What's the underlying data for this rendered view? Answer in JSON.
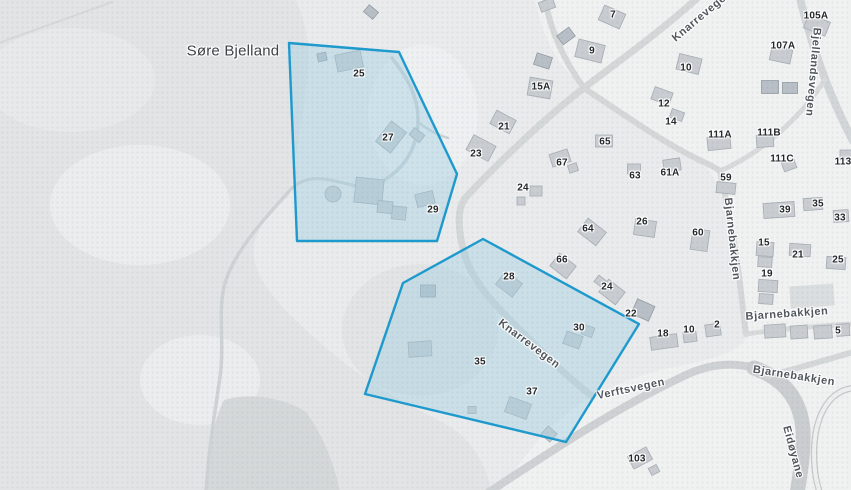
{
  "map": {
    "colors": {
      "base": "#e9ebec",
      "terrain_dark": "#e2e4e5",
      "terrain_light": "#ebedee",
      "field_dark": "#d5d8d9",
      "urban": "#f0f1f1",
      "building_fill": "#c9cdd1",
      "building_stroke": "#a6adb4",
      "building_dark": "#b9bfc6",
      "building_dark_stroke": "#959ca4",
      "building_light": "#dadedf",
      "selection_stroke": "#1d9ace",
      "selection_fill": "rgba(160,207,227,0.42)"
    },
    "place_labels": [
      {
        "text": "Søre Bjelland",
        "x": 233,
        "y": 51,
        "rot": 0
      }
    ],
    "street_labels": [
      {
        "text": "Knarrevegen",
        "x": 702,
        "y": 16,
        "rot": -40
      },
      {
        "text": "Bjellandsvegen",
        "x": 813,
        "y": 72,
        "rot": 95
      },
      {
        "text": "Bjarnebakkjen",
        "x": 732,
        "y": 239,
        "rot": 84
      },
      {
        "text": "Bjarnebakkjen",
        "x": 787,
        "y": 314,
        "rot": -4
      },
      {
        "text": "Bjarnebakkjen",
        "x": 794,
        "y": 376,
        "rot": 9
      },
      {
        "text": "Verftsvegen",
        "x": 631,
        "y": 389,
        "rot": -12
      },
      {
        "text": "Knarrevegen",
        "x": 529,
        "y": 344,
        "rot": 37
      },
      {
        "text": "Eidøyane",
        "x": 793,
        "y": 452,
        "rot": 75
      }
    ],
    "house_numbers": [
      {
        "text": "25",
        "x": 359,
        "y": 74
      },
      {
        "text": "27",
        "x": 388,
        "y": 138
      },
      {
        "text": "29",
        "x": 433,
        "y": 210
      },
      {
        "text": "7",
        "x": 613,
        "y": 15
      },
      {
        "text": "9",
        "x": 592,
        "y": 51
      },
      {
        "text": "15A",
        "x": 541,
        "y": 87
      },
      {
        "text": "21",
        "x": 504,
        "y": 127
      },
      {
        "text": "23",
        "x": 476,
        "y": 154
      },
      {
        "text": "24",
        "x": 523,
        "y": 188
      },
      {
        "text": "10",
        "x": 686,
        "y": 68
      },
      {
        "text": "12",
        "x": 664,
        "y": 104
      },
      {
        "text": "14",
        "x": 671,
        "y": 122
      },
      {
        "text": "105A",
        "x": 816,
        "y": 16
      },
      {
        "text": "107A",
        "x": 783,
        "y": 46
      },
      {
        "text": "111A",
        "x": 720,
        "y": 135
      },
      {
        "text": "111B",
        "x": 769,
        "y": 133
      },
      {
        "text": "111C",
        "x": 782,
        "y": 159
      },
      {
        "text": "113",
        "x": 843,
        "y": 162
      },
      {
        "text": "65",
        "x": 605,
        "y": 142
      },
      {
        "text": "67",
        "x": 562,
        "y": 163
      },
      {
        "text": "63",
        "x": 635,
        "y": 176
      },
      {
        "text": "61A",
        "x": 670,
        "y": 173
      },
      {
        "text": "59",
        "x": 726,
        "y": 178
      },
      {
        "text": "26",
        "x": 642,
        "y": 222
      },
      {
        "text": "64",
        "x": 588,
        "y": 229
      },
      {
        "text": "60",
        "x": 698,
        "y": 233
      },
      {
        "text": "66",
        "x": 562,
        "y": 260
      },
      {
        "text": "28",
        "x": 509,
        "y": 277
      },
      {
        "text": "24",
        "x": 607,
        "y": 287
      },
      {
        "text": "22",
        "x": 631,
        "y": 314
      },
      {
        "text": "30",
        "x": 579,
        "y": 328
      },
      {
        "text": "18",
        "x": 663,
        "y": 334
      },
      {
        "text": "10",
        "x": 689,
        "y": 330
      },
      {
        "text": "2",
        "x": 717,
        "y": 325
      },
      {
        "text": "39",
        "x": 785,
        "y": 210
      },
      {
        "text": "35",
        "x": 818,
        "y": 204
      },
      {
        "text": "33",
        "x": 840,
        "y": 218
      },
      {
        "text": "15",
        "x": 764,
        "y": 243
      },
      {
        "text": "21",
        "x": 798,
        "y": 255
      },
      {
        "text": "25",
        "x": 838,
        "y": 260
      },
      {
        "text": "19",
        "x": 767,
        "y": 274
      },
      {
        "text": "5",
        "x": 838,
        "y": 331
      },
      {
        "text": "35",
        "x": 480,
        "y": 362
      },
      {
        "text": "37",
        "x": 532,
        "y": 392
      },
      {
        "text": "103",
        "x": 637,
        "y": 459
      }
    ],
    "selection": {
      "stroke": "#1d9ace",
      "fill": "rgba(160,207,227,0.42)",
      "polygons": [
        [
          [
            289,
            43
          ],
          [
            399,
            52
          ],
          [
            457,
            174
          ],
          [
            437,
            241
          ],
          [
            297,
            241
          ]
        ],
        [
          [
            483,
            239
          ],
          [
            403,
            283
          ],
          [
            365,
            394
          ],
          [
            566,
            442
          ],
          [
            639,
            324
          ]
        ]
      ]
    },
    "terrain": [
      {
        "kind": "path",
        "fill": "terrain_dark",
        "d": "M0,0 L295,0 C312,30 310,70 303,110 C297,150 293,175 289,196 C270,213 251,230 254,258 C259,290 298,324 336,356 C370,384 402,402 438,420 C468,434 484,458 492,492 L0,492 Z"
      },
      {
        "kind": "ellipse",
        "fill": "terrain_light",
        "cx": 140,
        "cy": 205,
        "rx": 90,
        "ry": 60
      },
      {
        "kind": "ellipse",
        "fill": "terrain_light",
        "cx": 200,
        "cy": 380,
        "rx": 60,
        "ry": 45
      },
      {
        "kind": "ellipse",
        "fill": "#e7e9ea",
        "cx": 70,
        "cy": 80,
        "rx": 85,
        "ry": 52
      },
      {
        "kind": "ellipse",
        "fill": "terrain_dark",
        "cx": 420,
        "cy": 330,
        "rx": 78,
        "ry": 66
      },
      {
        "kind": "path",
        "fill": "field_dark",
        "d": "M204,492 C208,448 214,420 224,400 C250,392 285,398 306,412 C322,434 334,462 340,492 Z"
      },
      {
        "kind": "path",
        "fill": "urban",
        "d": "M535,0 L851,0 L851,492 L500,492 C525,452 548,428 572,410 C605,386 645,372 688,364 C722,357 746,348 747,334 C741,296 735,255 726,213 C719,184 711,170 698,158 C658,135 618,110 584,86 C558,68 543,38 535,0 Z"
      },
      {
        "kind": "ellipse",
        "fill": "#eef0f1",
        "cx": 423,
        "cy": 115,
        "rx": 55,
        "ry": 70
      }
    ],
    "roads": [
      {
        "n": "road-path",
        "d": "M-4,44 L112,2",
        "w": 2,
        "c": "#d6d9da"
      },
      {
        "n": "road-country",
        "d": "M292,188 C263,220 236,250 226,280 C216,310 226,344 219,384 C213,424 208,456 206,494",
        "w": 3.5,
        "c": "#cfd3d5"
      },
      {
        "n": "road-country",
        "d": "M292,188 C310,172 330,180 356,186",
        "w": 3,
        "c": "#cdd2d5"
      },
      {
        "n": "road-knarrevegen",
        "d": "M702,-6 C658,34 612,66 584,88 C546,117 497,164 467,196 C456,208 458,230 464,252 C471,279 490,300 514,324 C540,350 566,376 592,396",
        "w": 7,
        "c": "#d5d8d9"
      },
      {
        "n": "road",
        "d": "M544,-6 C549,26 562,58 584,88",
        "w": 6,
        "c": "#d5d8d9"
      },
      {
        "n": "road",
        "d": "M584,88 C626,116 668,146 706,163 C712,166 716,168 720,171",
        "w": 6,
        "c": "#d5d8d9"
      },
      {
        "n": "road-bjellandsvegen",
        "d": "M799,-6 C806,24 815,52 825,79 C834,102 843,122 853,141",
        "w": 8,
        "c": "#d3d6d8"
      },
      {
        "n": "road",
        "d": "M825,79 C805,112 765,152 720,171",
        "w": 5,
        "c": "#d8dadb"
      },
      {
        "n": "road-bjarnebakkjen",
        "d": "M720,171 C727,202 734,240 739,276 C742,300 744,320 746,334",
        "w": 6,
        "c": "#d5d8d9"
      },
      {
        "n": "road-bjarnebakkjen",
        "d": "M746,334 C781,329 816,326 853,324",
        "w": 5,
        "c": "#d8dadb"
      },
      {
        "n": "road-verftsvegen",
        "d": "M486,494 C556,448 616,408 686,375 C716,361 744,362 766,373",
        "w": 8,
        "c": "#cfd2d4"
      },
      {
        "n": "road-eidoyane",
        "d": "M754,368 C788,380 801,404 803,430 C804,454 800,474 797,494",
        "w": 15,
        "c": "#cbced0"
      },
      {
        "n": "road-bjarnebakkjen",
        "d": "M768,376 C798,368 826,360 853,352",
        "w": 6,
        "c": "#d5d8d9"
      },
      {
        "n": "road-loop",
        "d": "M853,388 C824,392 814,424 814,454 C814,472 817,484 820,494",
        "w": 6.5,
        "c": "#c6cacc"
      },
      {
        "n": "road-loop",
        "d": "M853,388 C824,392 814,424 814,454 C814,472 817,484 820,494",
        "w": 4,
        "c": "#eef0f0"
      },
      {
        "n": "road-driveway",
        "d": "M392,58 C406,76 419,96 418,122 C417,147 406,166 386,179 C376,186 366,189 358,189",
        "w": 3.5,
        "c": "#ccd3d7"
      },
      {
        "n": "road-driveway",
        "d": "M418,122 C428,130 438,135 448,138",
        "w": 2.5,
        "c": "#ccd3d7"
      }
    ],
    "buildings": [
      [
        349,
        61,
        26,
        17,
        -12,
        "n"
      ],
      [
        322,
        57,
        9,
        8,
        -12,
        "d"
      ],
      [
        371,
        12,
        12,
        9,
        40,
        "d"
      ],
      [
        391,
        137,
        19,
        26,
        38,
        "n"
      ],
      [
        417,
        135,
        13,
        9,
        38,
        "n"
      ],
      [
        369,
        191,
        28,
        25,
        6,
        "n"
      ],
      [
        385,
        207,
        15,
        12,
        6,
        "n"
      ],
      [
        399,
        213,
        14,
        13,
        6,
        "n"
      ],
      [
        333,
        194,
        16,
        16,
        0,
        "n",
        "circle"
      ],
      [
        425,
        199,
        18,
        13,
        -14,
        "n"
      ],
      [
        509,
        284,
        21,
        17,
        38,
        "n"
      ],
      [
        428,
        291,
        15,
        12,
        0,
        "d"
      ],
      [
        420,
        349,
        23,
        15,
        -4,
        "n"
      ],
      [
        573,
        340,
        17,
        13,
        20,
        "n"
      ],
      [
        588,
        331,
        11,
        10,
        20,
        "n"
      ],
      [
        518,
        408,
        23,
        16,
        20,
        "n"
      ],
      [
        549,
        434,
        12,
        11,
        42,
        "n"
      ],
      [
        472,
        410,
        8,
        7,
        0,
        "n"
      ],
      [
        612,
        17,
        23,
        16,
        24,
        "n"
      ],
      [
        590,
        51,
        27,
        18,
        14,
        "n"
      ],
      [
        566,
        36,
        15,
        11,
        -36,
        "d"
      ],
      [
        543,
        61,
        16,
        12,
        18,
        "d"
      ],
      [
        547,
        5,
        15,
        10,
        -20,
        "n"
      ],
      [
        540,
        88,
        23,
        18,
        10,
        "n"
      ],
      [
        503,
        122,
        22,
        15,
        28,
        "n"
      ],
      [
        481,
        148,
        25,
        17,
        28,
        "n"
      ],
      [
        604,
        141,
        17,
        12,
        0,
        "n"
      ],
      [
        560,
        158,
        19,
        13,
        -18,
        "n"
      ],
      [
        573,
        168,
        9,
        8,
        -18,
        "n"
      ],
      [
        634,
        169,
        13,
        10,
        0,
        "n"
      ],
      [
        672,
        165,
        17,
        12,
        -8,
        "n"
      ],
      [
        689,
        64,
        23,
        16,
        14,
        "n"
      ],
      [
        662,
        96,
        19,
        13,
        20,
        "n"
      ],
      [
        677,
        115,
        13,
        9,
        20,
        "n"
      ],
      [
        817,
        25,
        23,
        15,
        22,
        "n"
      ],
      [
        781,
        55,
        21,
        14,
        12,
        "n"
      ],
      [
        770,
        87,
        17,
        13,
        0,
        "d"
      ],
      [
        790,
        88,
        15,
        11,
        0,
        "d"
      ],
      [
        719,
        143,
        23,
        13,
        -6,
        "n"
      ],
      [
        765,
        141,
        17,
        12,
        -4,
        "n"
      ],
      [
        789,
        165,
        13,
        10,
        -20,
        "n"
      ],
      [
        846,
        155,
        12,
        10,
        0,
        "n"
      ],
      [
        726,
        188,
        19,
        11,
        6,
        "n"
      ],
      [
        700,
        240,
        17,
        21,
        8,
        "n"
      ],
      [
        779,
        210,
        31,
        15,
        -4,
        "n"
      ],
      [
        813,
        204,
        19,
        12,
        -4,
        "n"
      ],
      [
        841,
        216,
        15,
        12,
        -4,
        "n"
      ],
      [
        765,
        249,
        17,
        14,
        4,
        "n"
      ],
      [
        765,
        262,
        14,
        10,
        4,
        "n"
      ],
      [
        768,
        286,
        19,
        12,
        4,
        "n"
      ],
      [
        766,
        299,
        14,
        10,
        4,
        "n"
      ],
      [
        800,
        250,
        21,
        12,
        4,
        "n"
      ],
      [
        836,
        263,
        19,
        12,
        4,
        "n"
      ],
      [
        812,
        296,
        44,
        22,
        -4,
        "l"
      ],
      [
        775,
        331,
        21,
        13,
        -4,
        "n"
      ],
      [
        799,
        332,
        17,
        13,
        -4,
        "n"
      ],
      [
        823,
        332,
        18,
        13,
        -4,
        "n"
      ],
      [
        843,
        330,
        13,
        12,
        -4,
        "n"
      ],
      [
        664,
        342,
        27,
        13,
        -8,
        "n"
      ],
      [
        690,
        337,
        13,
        10,
        -8,
        "n"
      ],
      [
        713,
        330,
        15,
        12,
        -8,
        "n"
      ],
      [
        643,
        310,
        19,
        16,
        24,
        "d"
      ],
      [
        592,
        232,
        23,
        17,
        38,
        "n"
      ],
      [
        645,
        228,
        21,
        16,
        8,
        "n"
      ],
      [
        563,
        266,
        21,
        16,
        38,
        "n"
      ],
      [
        612,
        292,
        21,
        16,
        38,
        "n"
      ],
      [
        600,
        281,
        9,
        8,
        38,
        "n"
      ],
      [
        536,
        191,
        12,
        10,
        0,
        "n"
      ],
      [
        521,
        201,
        8,
        8,
        0,
        "n"
      ],
      [
        640,
        458,
        21,
        14,
        -28,
        "n"
      ],
      [
        654,
        470,
        9,
        8,
        -28,
        "n"
      ]
    ]
  }
}
